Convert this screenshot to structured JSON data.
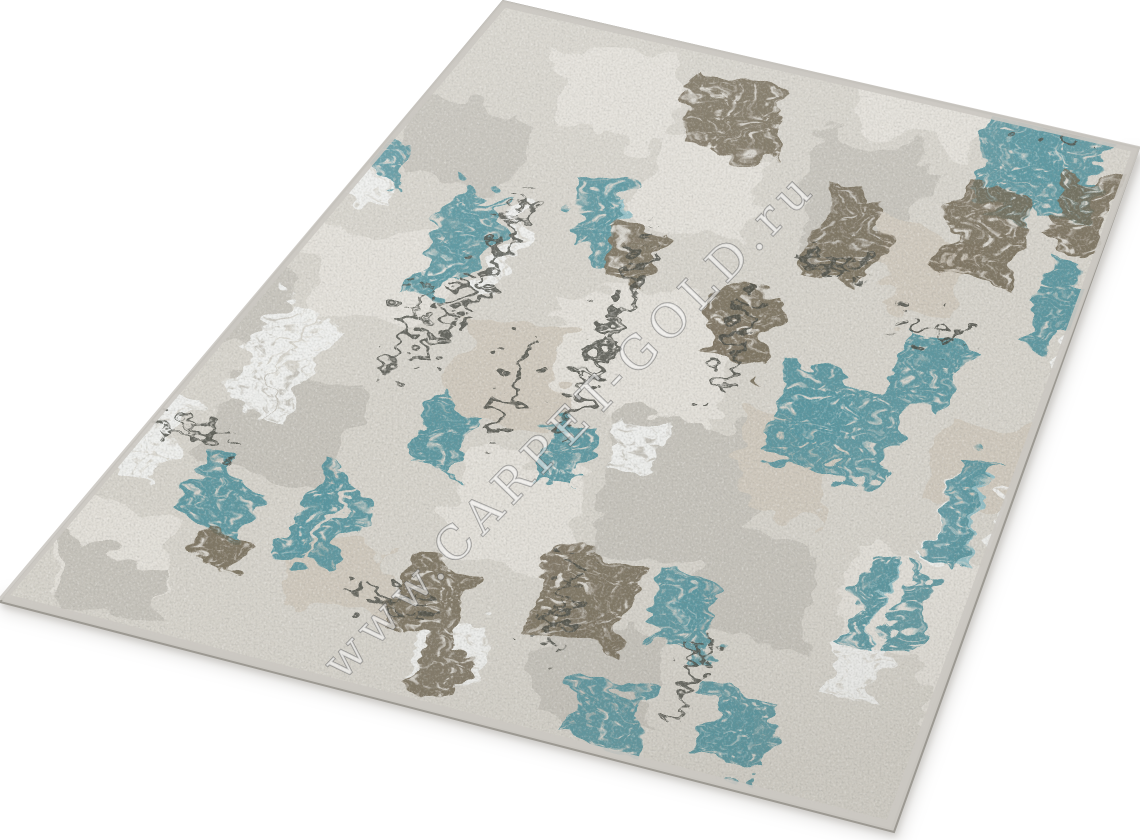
{
  "photo": {
    "description": "Angled product photo of a modern distressed abstract area rug in light grey with teal, bronze-brown and silver accents on a white background",
    "background_color": "#ffffff"
  },
  "watermark": {
    "text": "www.CARPET-GOLD.ru",
    "fill_color": "#ffffff",
    "outline_color": "#707070"
  },
  "rug": {
    "colors": {
      "base": "#d5d2ca",
      "patch_light": "#e2dfd8",
      "patch_dark": "#c4c1b9",
      "patch_taupe": "#cec7bb",
      "silver": "#f0f1ef",
      "teal": "#4f8e99",
      "teal_light": "#8cbcc4",
      "brown": "#6e6350",
      "charcoal": "#45463f",
      "side": "#c8c5bf",
      "edge_line": "#9c9992",
      "band": "#cbc8c2",
      "shadow": "#bab7b2"
    }
  }
}
